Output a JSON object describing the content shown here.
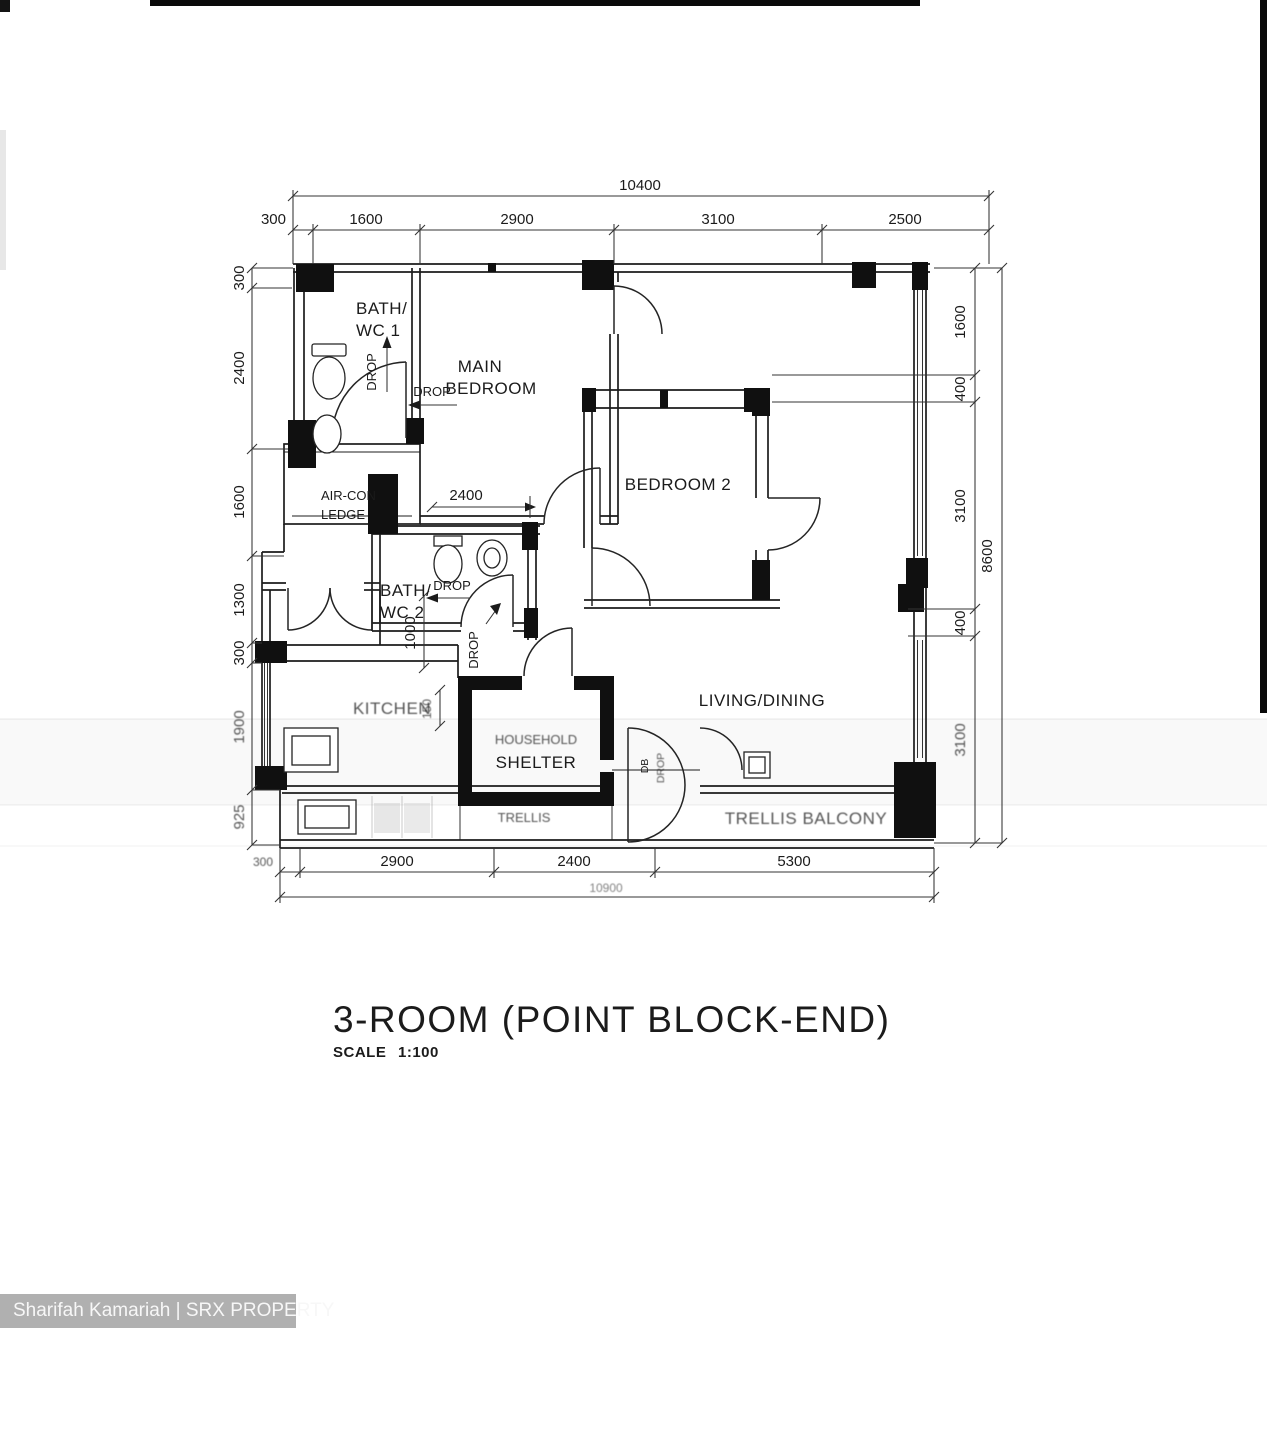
{
  "title": {
    "name": "3-ROOM (POINT BLOCK-END)",
    "scale_label": "SCALE",
    "scale_value": "1:100"
  },
  "watermark": {
    "text": "Sharifah Kamariah | SRX PROPERTY"
  },
  "rooms": {
    "bath1_l1": "BATH/",
    "bath1_l2": "WC 1",
    "main_bedroom_l1": "MAIN",
    "main_bedroom_l2": "BEDROOM",
    "aircon_l1": "AIR-CON",
    "aircon_l2": "LEDGE",
    "bath2_l1": "BATH/",
    "bath2_l2": "WC 2",
    "bedroom2": "BEDROOM 2",
    "kitchen": "KITCHEN",
    "shelter_l1": "HOUSEHOLD",
    "shelter_l2": "SHELTER",
    "living": "LIVING/DINING",
    "trellis": "TRELLIS",
    "balcony": "TRELLIS BALCONY",
    "db": "DB"
  },
  "annotations": {
    "drop": "DROP"
  },
  "dims": {
    "top_overall": "10400",
    "top": [
      "300",
      "1600",
      "2900",
      "3100",
      "2500"
    ],
    "left": [
      "300",
      "2400",
      "1600",
      "1300",
      "300",
      "1900",
      "925"
    ],
    "right": [
      "1600",
      "400",
      "3100",
      "400",
      "3100"
    ],
    "right_overall": "8600",
    "bottom": [
      "300",
      "2900",
      "2400",
      "5300"
    ],
    "bottom_overall": "10900",
    "interior": {
      "mbr": "2400",
      "hall": "1000",
      "kitchen": "150"
    }
  }
}
